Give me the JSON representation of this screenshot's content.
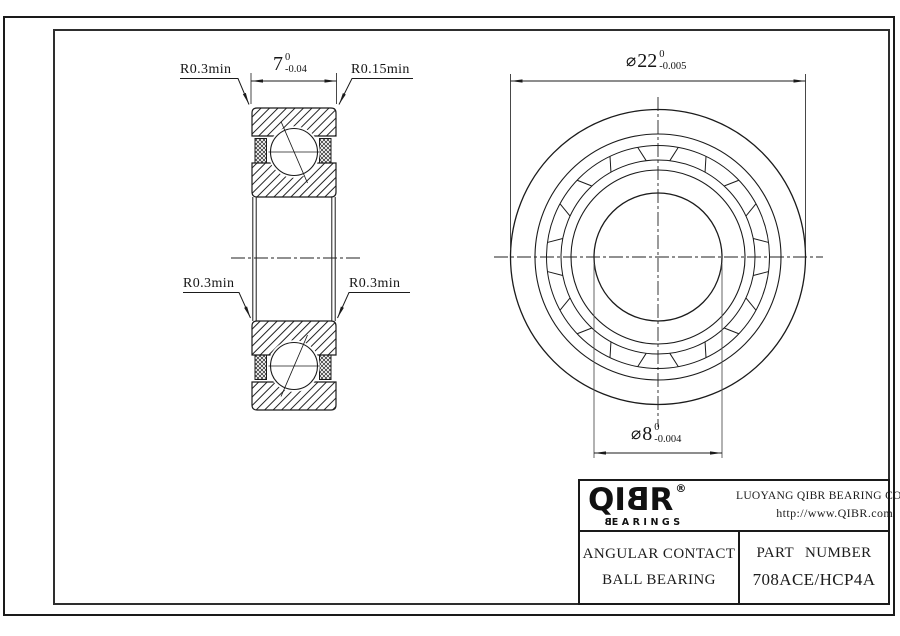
{
  "drawing": {
    "labels": {
      "top_left": "R0.3min",
      "top_right": "R0.15min",
      "mid_left": "R0.3min",
      "mid_right": "R0.3min"
    },
    "dimensions": {
      "width": {
        "value": "7",
        "tol_upper": "0",
        "tol_lower": "-0.04"
      },
      "outer_diameter": {
        "symbol": "⌀",
        "value": "22",
        "tol_upper": "0",
        "tol_lower": "-0.005"
      },
      "bore_diameter": {
        "symbol": "⌀",
        "value": "8",
        "tol_upper": "0",
        "tol_lower": "-0.004"
      }
    }
  },
  "title_block": {
    "logo": {
      "part1": "QI",
      "mirrored_b": "B",
      "part2": "R",
      "registered": "®",
      "sub_mirrored_b": "B",
      "sub_rest": "EARINGS"
    },
    "company": "LUOYANG QIBR BEARING CO., LTD",
    "website": "http://www.QIBR.com",
    "product_line1": "ANGULAR CONTACT",
    "product_line2": "BALL BEARING",
    "part_number_label": "PART NUMBER",
    "part_number": "708ACE/HCP4A"
  },
  "colors": {
    "line": "#1b1b1b",
    "background": "#ffffff"
  }
}
